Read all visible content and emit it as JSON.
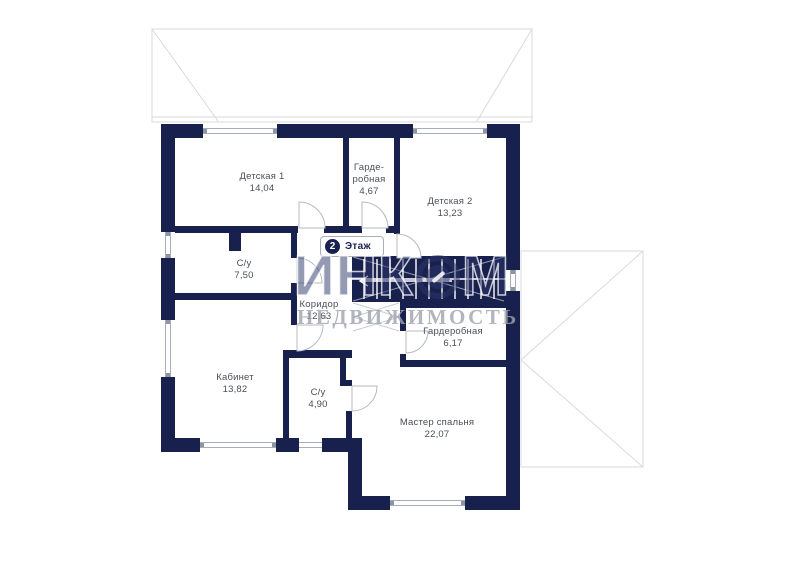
{
  "floor_badge": {
    "number": "2",
    "label": "Этаж"
  },
  "watermark": {
    "brand_prefix": "ИНК",
    "brand_suffix": "М",
    "subtitle": "НЕДВИЖИМОСТЬ"
  },
  "rooms": [
    {
      "name": "Детская 1",
      "area": "14,04"
    },
    {
      "name": "Гарде-\nробная",
      "area": "4,67"
    },
    {
      "name": "Детская 2",
      "area": "13,23"
    },
    {
      "name": "С/у",
      "area": "7,50"
    },
    {
      "name": "Коридор",
      "area": "12,63"
    },
    {
      "name": "Гардеробная",
      "area": "6,17"
    },
    {
      "name": "Кабинет",
      "area": "13,82"
    },
    {
      "name": "С/у",
      "area": "4,90"
    },
    {
      "name": "Мастер спальня",
      "area": "22,07"
    }
  ],
  "colors": {
    "wall": "#18204e",
    "roof_line": "#d9d9d9",
    "label_text": "#4a4f58",
    "badge_circle": "#1a2150",
    "watermark_brand": "rgba(44,54,104,0.5)",
    "watermark_subtitle": "rgba(158,163,173,0.8)"
  }
}
